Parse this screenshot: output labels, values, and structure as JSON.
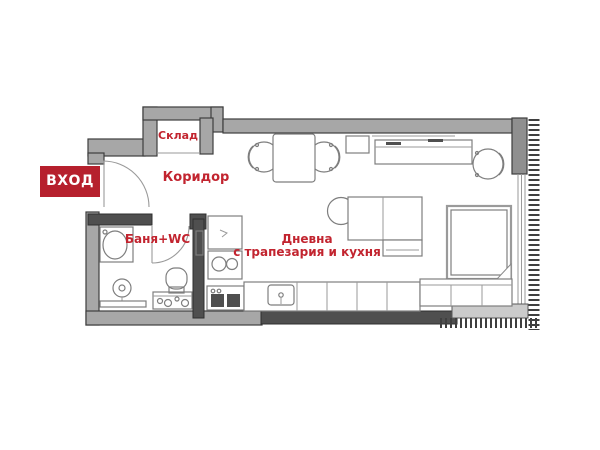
{
  "labels": {
    "entrance": "ВХОД",
    "storage": "Склад",
    "corridor": "Коридор",
    "bathroom": "Баня+WC",
    "living_line1": "Дневна",
    "living_line2": "с трапезария и кухня"
  },
  "colors": {
    "badge_red": "#b6202d",
    "label_red": "#c2242f",
    "wall_gray": "#a7a7a7",
    "wall_mid": "#8f8f8f",
    "wall_dark": "#4f4f4f",
    "sill_gray": "#cbcbcb",
    "furniture_line": "#7e7e7e"
  }
}
